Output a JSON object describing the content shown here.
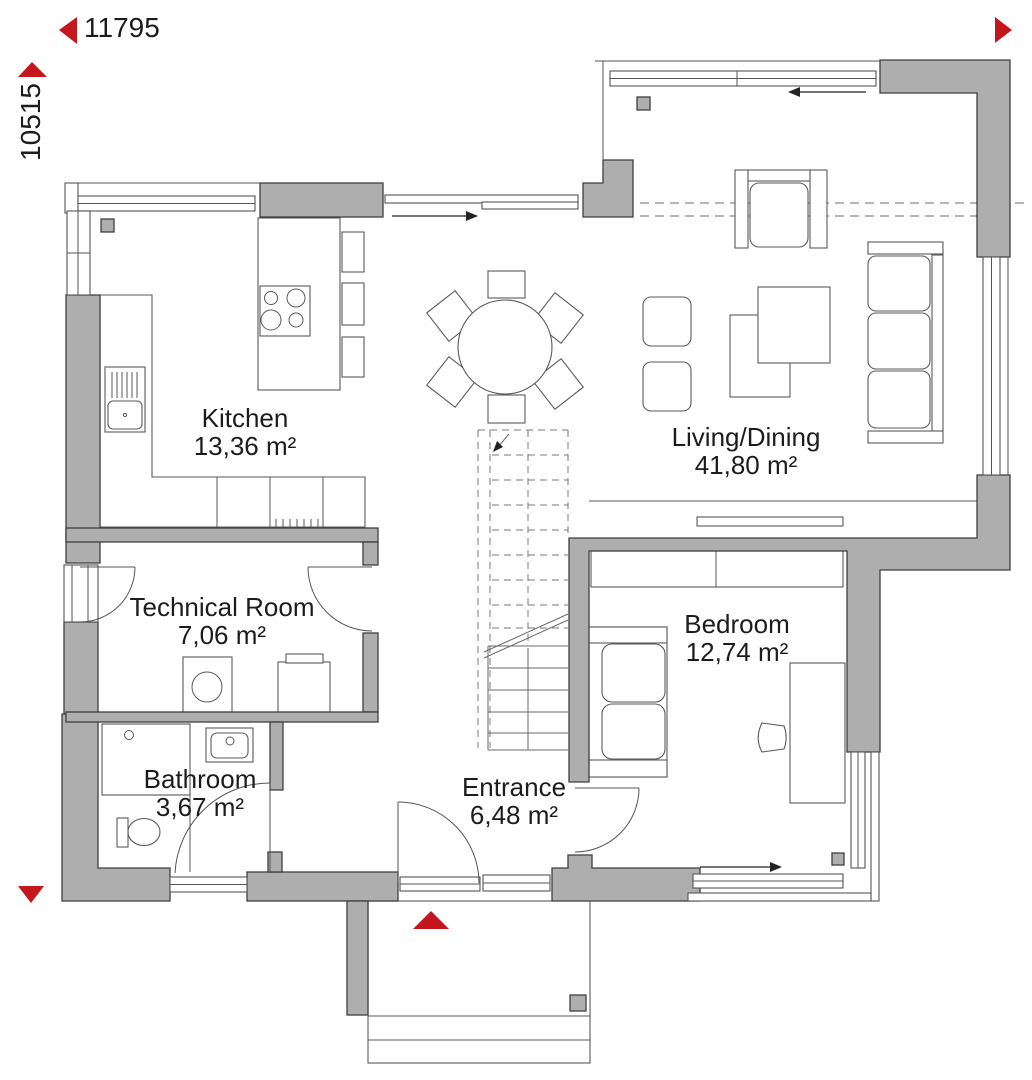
{
  "page": {
    "type": "architectural floor plan, ground floor",
    "background": "#ffffff"
  },
  "dimensions": {
    "width_mm": "11795",
    "height_mm": "10515"
  },
  "rooms": [
    {
      "name": "Kitchen",
      "area": "13,36 m²"
    },
    {
      "name": "Living/Dining",
      "area": "41,80 m²"
    },
    {
      "name": "Technical Room",
      "area": "7,06 m²"
    },
    {
      "name": "Bedroom",
      "area": "12,74 m²"
    },
    {
      "name": "Bathroom",
      "area": "3,67 m²"
    },
    {
      "name": "Entrance",
      "area": "6,48 m²"
    }
  ],
  "colors": {
    "wall_fill": "#aeaeae",
    "wall_outline": "#3f3f3f",
    "furniture_line": "#5a5a5a",
    "dashed_overhang": "#8a8a8a",
    "accent_red": "#c5161d",
    "label_text": "#1c1c1c"
  },
  "markers": {
    "width_arrow_left": "left-triangle",
    "width_arrow_right": "right-triangle",
    "height_arrow_up": "up-triangle",
    "height_arrow_down": "down-triangle",
    "entrance_marker": "up-triangle",
    "sliding_window_arrows": "direction-arrows"
  }
}
